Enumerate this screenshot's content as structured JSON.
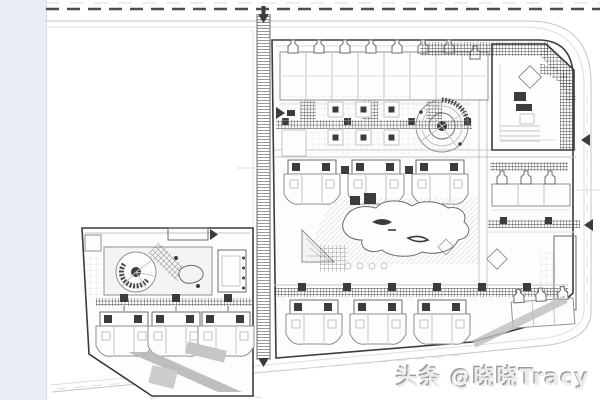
{
  "watermark": {
    "brand": "头条",
    "handle": "@晓晓Tracy",
    "text": "头条 @晓晓Tracy"
  },
  "colors": {
    "background": "#ffffff",
    "strip": "#e9eef4",
    "strip_border": "#d6dde3",
    "line": "#8f8f8f",
    "line_light": "#c5c5c5",
    "line_faint": "#dedede",
    "mid": "#6b6b6b",
    "dark": "#3c3c3c",
    "fill_white": "#fdfdfd",
    "fill_light": "#f4f4f4",
    "gray_block": "#b7b7b7",
    "watermark_fill": "#ececec",
    "watermark_shadow": "#9e9e9e"
  }
}
